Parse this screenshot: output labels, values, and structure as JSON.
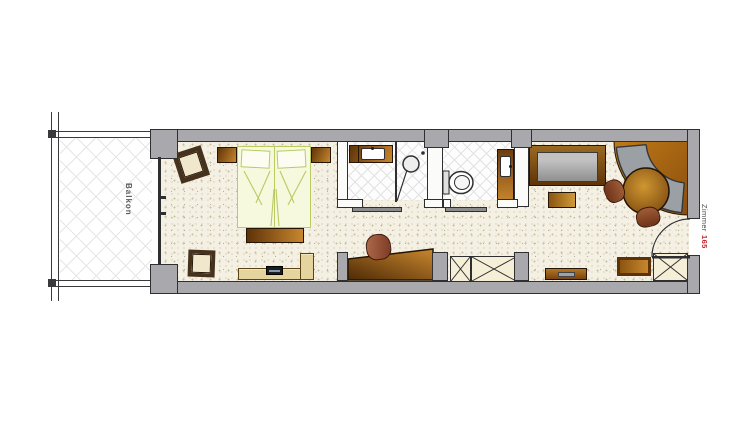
{
  "floor_plan": {
    "labels": {
      "balcony": "Balkon",
      "room_word": "Zimmer",
      "room_number": "165"
    },
    "colors": {
      "wall_fill": "#a9a9ad",
      "wall_outline": "#2f2f31",
      "floor_base": "#f4f0e4",
      "wood_dark": "#5e3408",
      "wood_light": "#c8872e",
      "bed_fill": "#f7f9df",
      "bed_outline": "#b9cb61",
      "upholstery_gray": "#9aa0a4",
      "cushion_cream": "#f0e7cd",
      "closet_fill": "#f6efd8",
      "room_number_red": "#c2242e"
    }
  }
}
